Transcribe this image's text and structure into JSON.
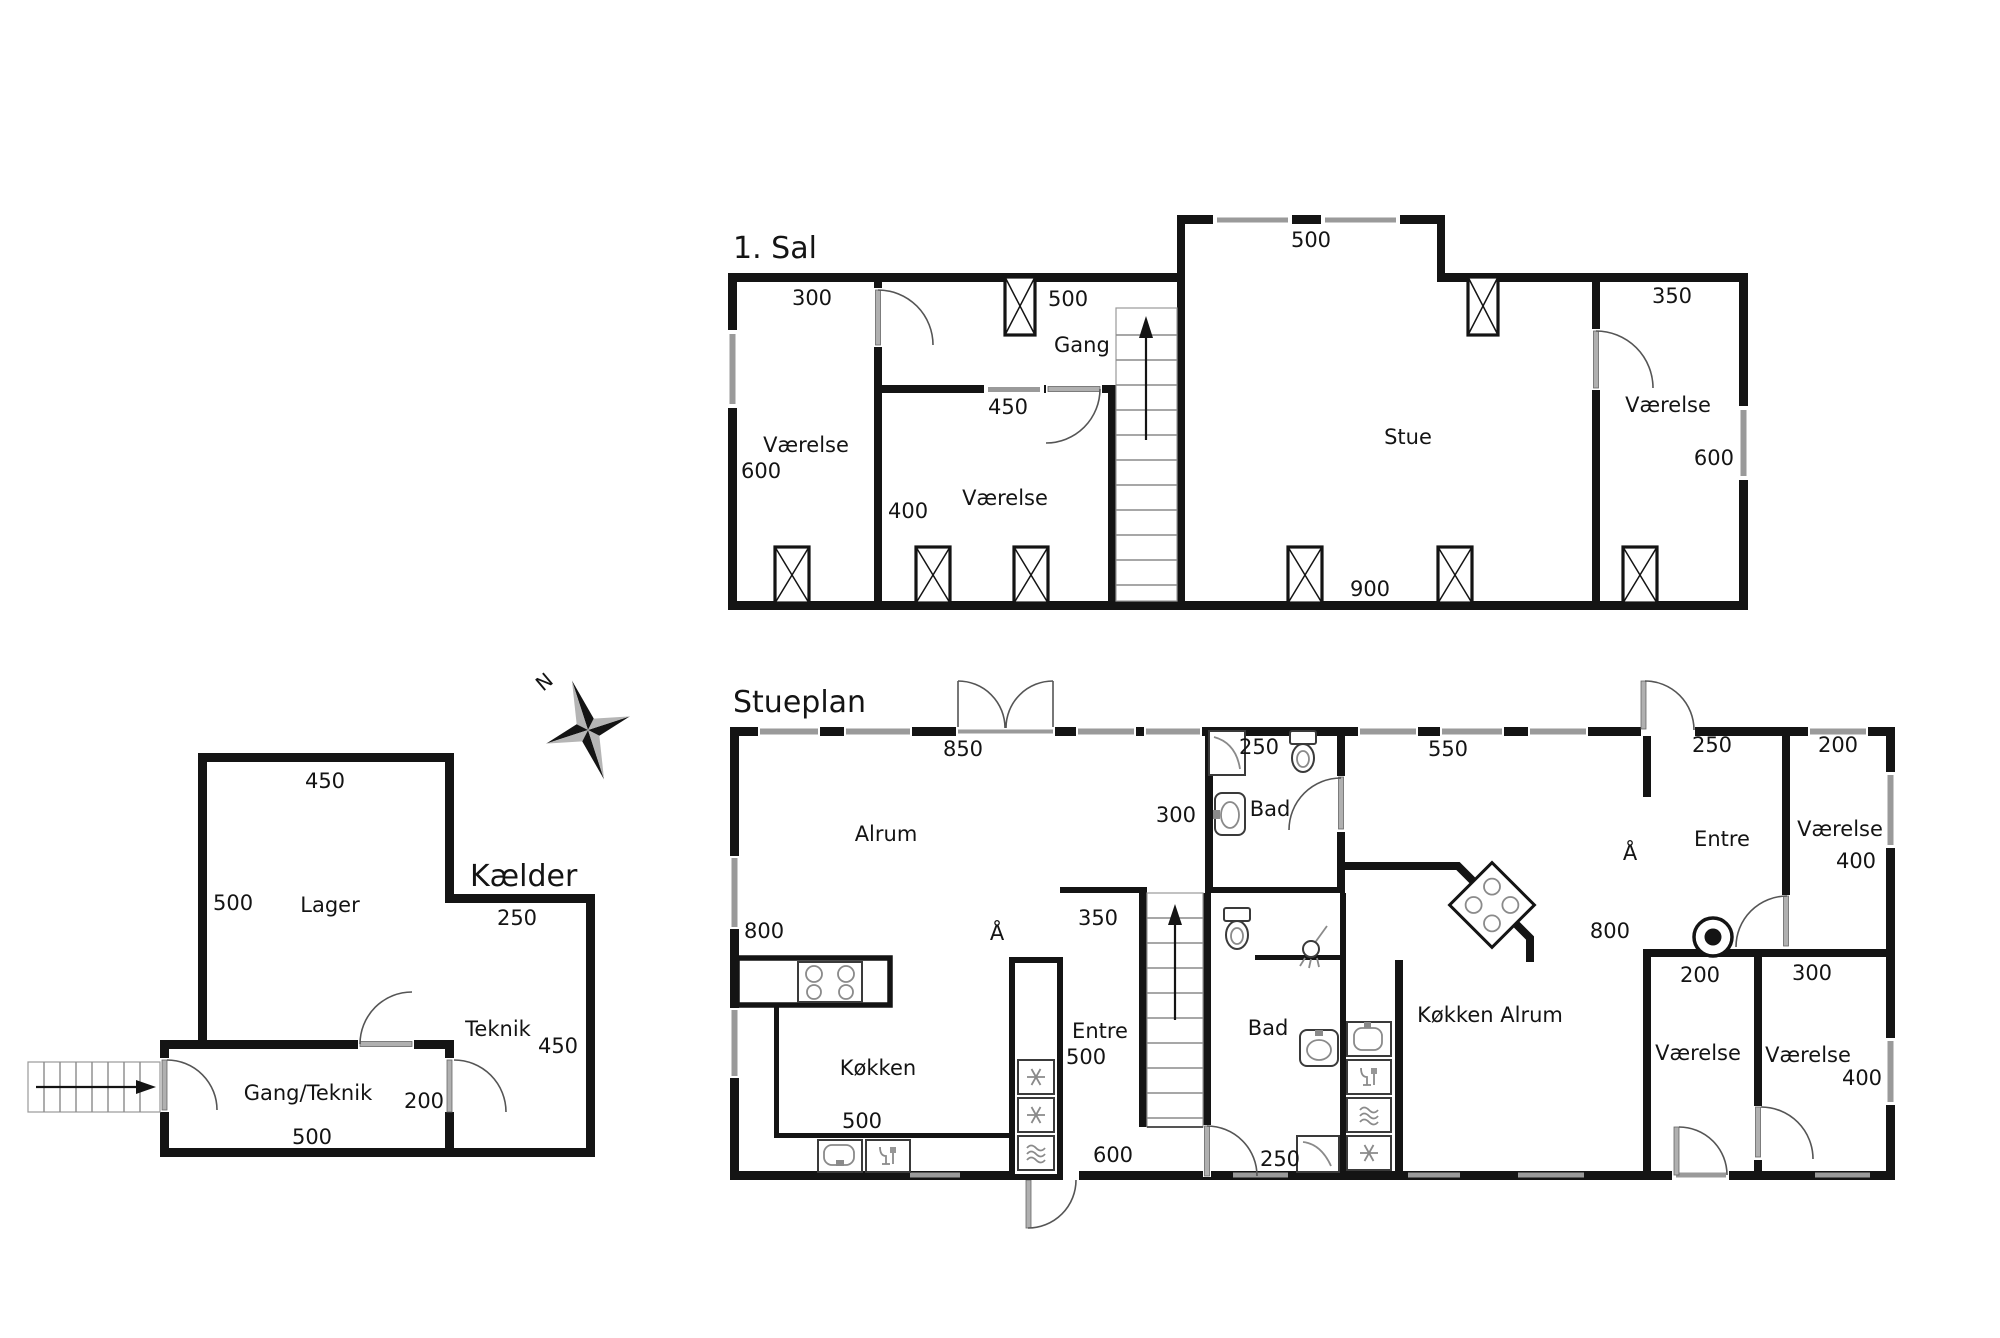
{
  "page": {
    "background": "#ffffff",
    "ink": "#141414",
    "window_color": "#9a9a9a"
  },
  "compass": {
    "north": "N"
  },
  "first_floor": {
    "title": "1. Sal",
    "rooms": {
      "room_left": "Værelse",
      "gang": "Gang",
      "room_mid": "Værelse",
      "stue": "Stue",
      "room_right": "Værelse"
    },
    "dims": {
      "room_left_width": "300",
      "room_left_height": "600",
      "gang_window": "500",
      "bump_window": "500",
      "room_mid_width": "450",
      "room_mid_height": "400",
      "stue_bottom": "900",
      "room_right_width": "350",
      "room_right_height": "600"
    }
  },
  "ground_floor": {
    "title": "Stueplan",
    "rooms": {
      "alrum": "Alrum",
      "bad_top": "Bad",
      "bad_bottom": "Bad",
      "koekken": "Køkken",
      "koekken_alrum": "Køkken Alrum",
      "entre_main": "Entre",
      "entre_right": "Entre",
      "room_tr": "Værelse",
      "room_b1": "Værelse",
      "room_b2": "Værelse"
    },
    "dims": {
      "alrum_top": "850",
      "left_wall": "800",
      "bad_top_width": "250",
      "bad_top_left": "300",
      "ka_top": "550",
      "entre_right_top": "250",
      "room_tr_top": "200",
      "room_tr_right": "400",
      "entre_right_left": "800",
      "koekken_bottom": "500",
      "appliance": "500",
      "entre_main_top": "350",
      "entre_main_bottom": "600",
      "bad_bottom_dim": "250",
      "room_b1_top": "200",
      "room_b2_top": "300",
      "room_b2_right": "400"
    },
    "open_marks": {
      "aa_left": "Å",
      "aa_right": "Å"
    }
  },
  "basement": {
    "title": "Kælder",
    "rooms": {
      "lager": "Lager",
      "teknik": "Teknik",
      "gang_teknik": "Gang/Teknik"
    },
    "dims": {
      "lager_top": "450",
      "lager_left": "500",
      "teknik_top": "250",
      "teknik_right": "450",
      "gt_door": "200",
      "gt_bottom": "500"
    }
  }
}
